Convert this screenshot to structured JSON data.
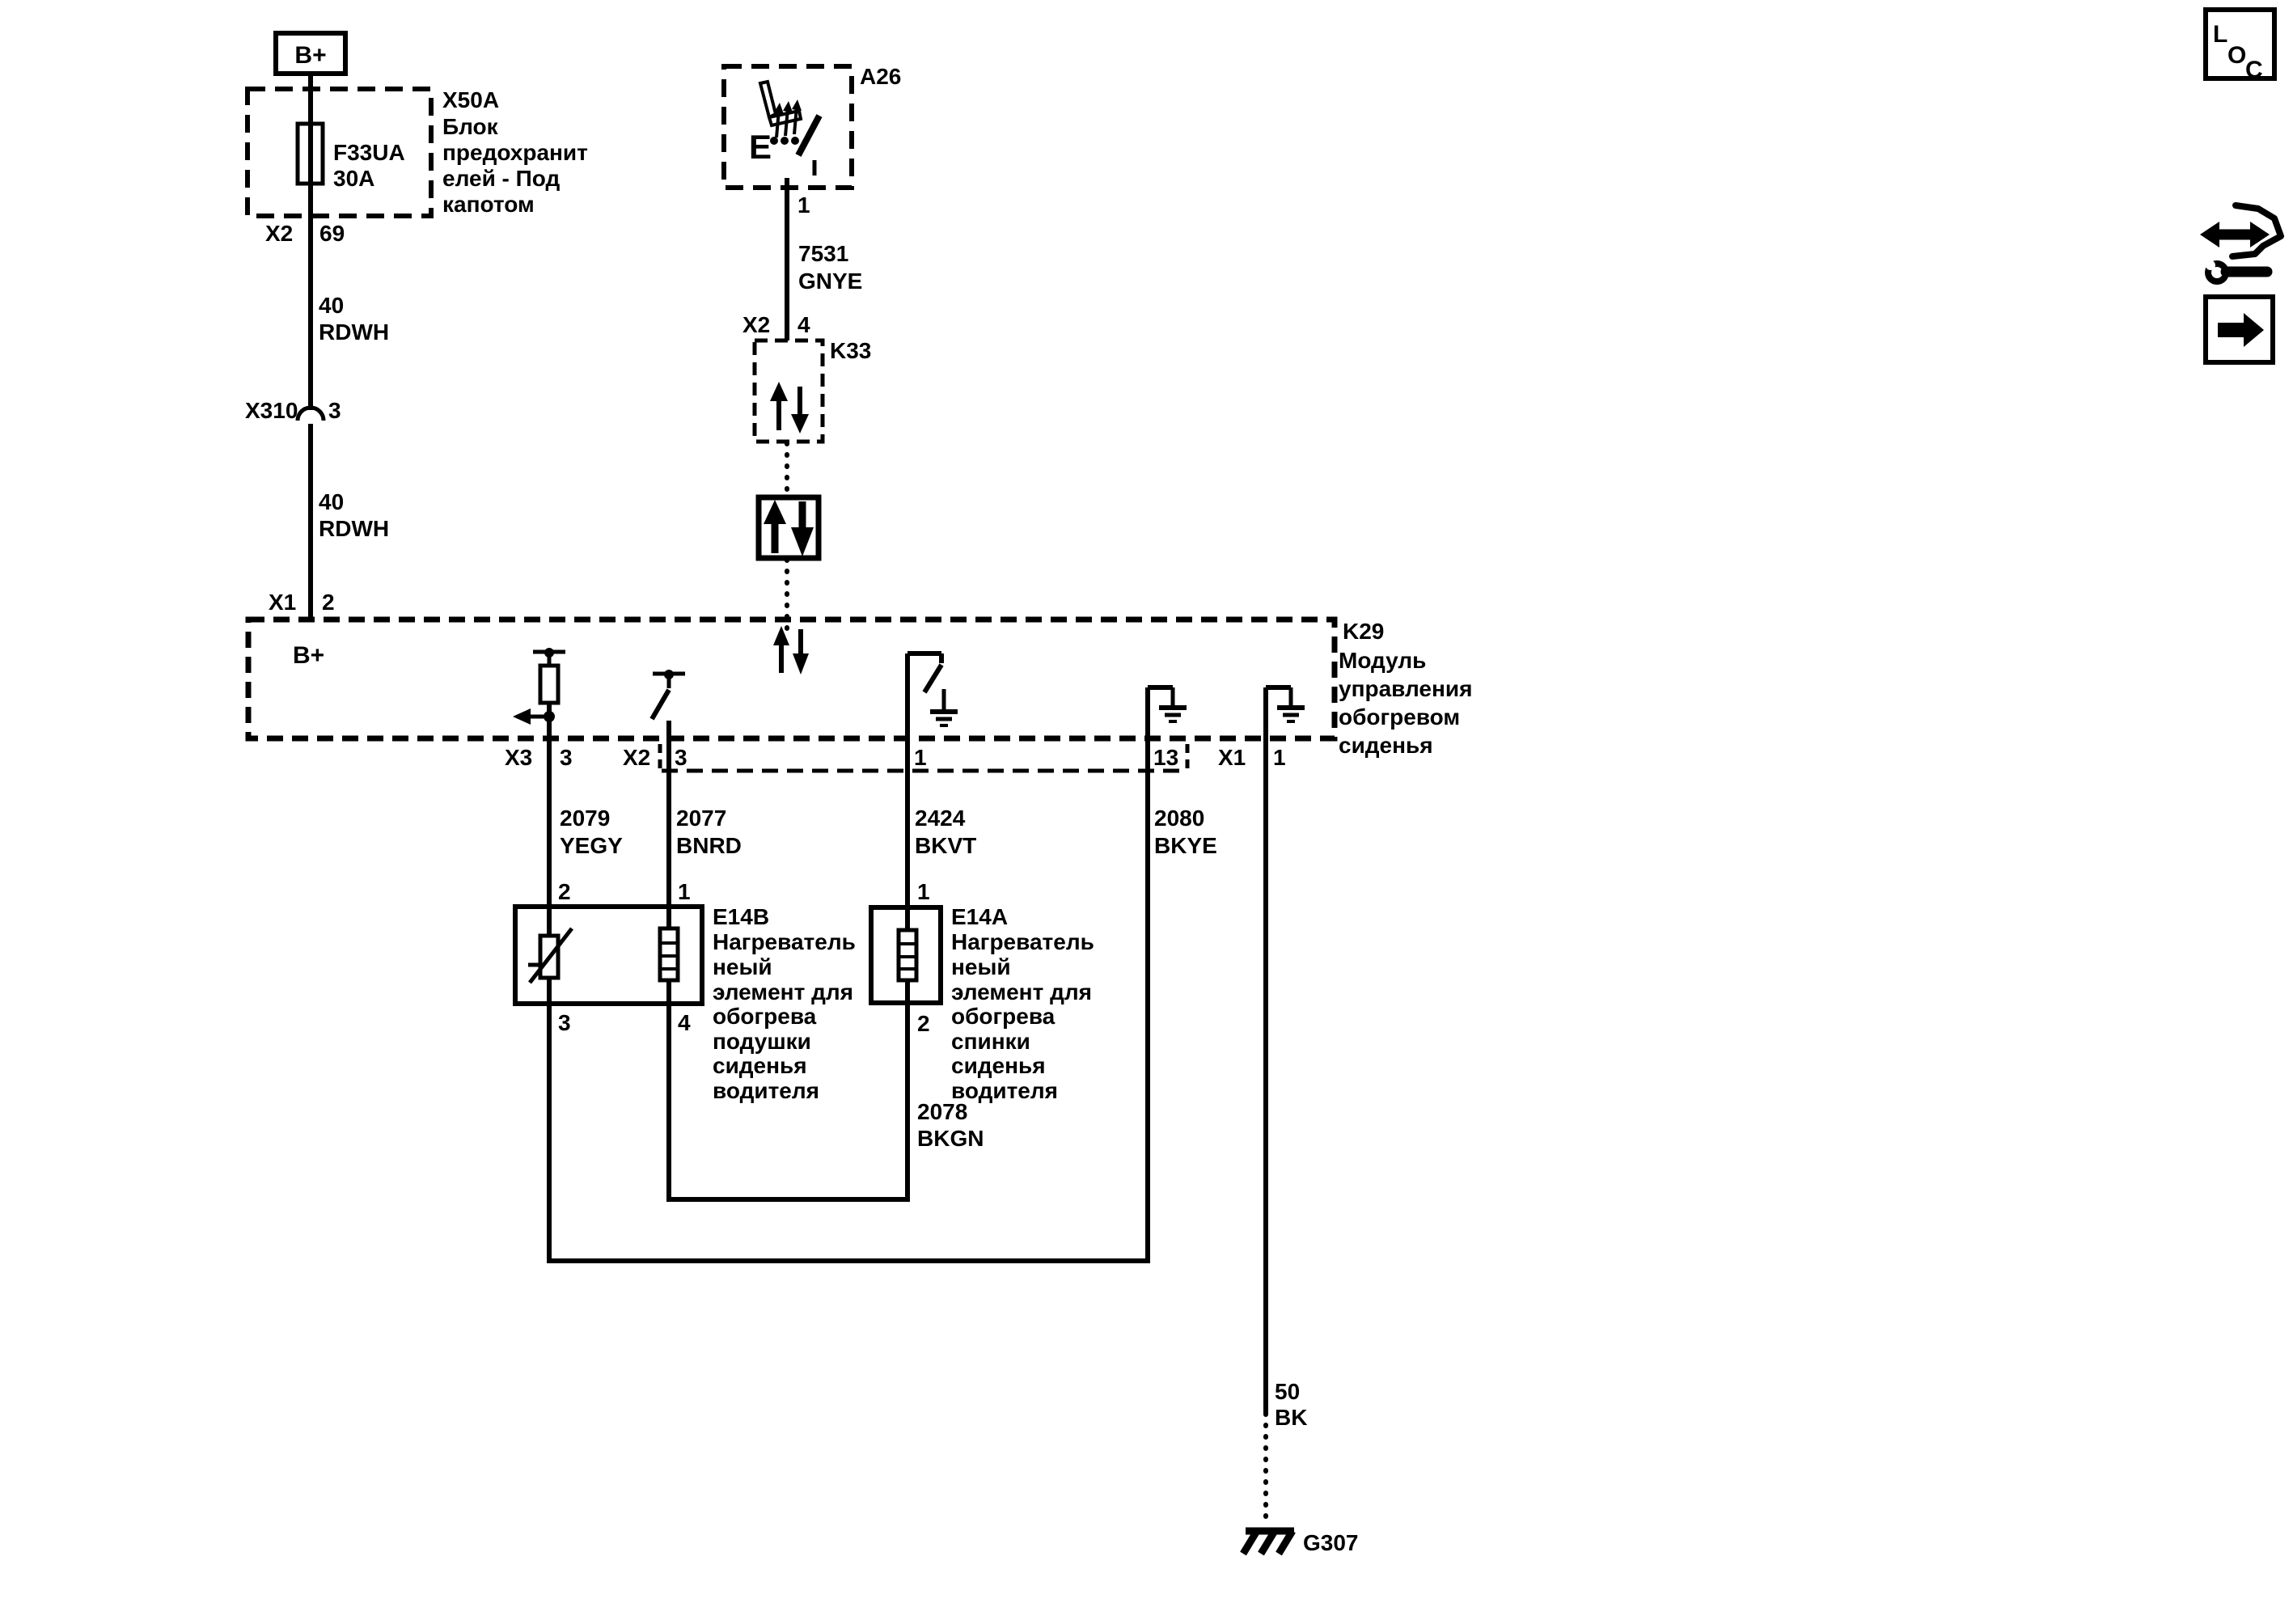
{
  "page": {
    "background": "#ffffff",
    "ink": "#000000"
  },
  "power": {
    "label": "B+"
  },
  "fuse_block": {
    "id": "X50A",
    "name_lines": [
      "Блок",
      "предохранит",
      "елей - Под",
      "капотом"
    ],
    "fuse_id": "F33UA",
    "fuse_rating": "30A",
    "out_connector": "X2",
    "out_pin": "69"
  },
  "wire_40_upper": {
    "circuit": "40",
    "color": "RDWH"
  },
  "inline_connector": {
    "id": "X310",
    "pin": "3"
  },
  "wire_40_lower": {
    "circuit": "40",
    "color": "RDWH"
  },
  "switch_assembly": {
    "id": "A26",
    "contact_letter": "E",
    "pin": "1"
  },
  "wire_7531": {
    "circuit": "7531",
    "color": "GNYE"
  },
  "k33": {
    "id": "K33",
    "connector": "X2",
    "pin": "4"
  },
  "k29": {
    "id": "K29",
    "name_lines": [
      "Модуль",
      "управления",
      "обогревом",
      "сиденья"
    ],
    "internal_b_plus": "B+",
    "in_connector": "X1",
    "in_pin": "2",
    "x3_label": "X3",
    "x3_pin": "3",
    "x2_label": "X2",
    "x2_pin_a": "3",
    "x2_pin_b": "1",
    "x2_pin_c": "13",
    "x1_label": "X1",
    "x1_pin": "1"
  },
  "wire_2079": {
    "circuit": "2079",
    "color": "YEGY"
  },
  "wire_2077": {
    "circuit": "2077",
    "color": "BNRD"
  },
  "wire_2424": {
    "circuit": "2424",
    "color": "BKVT"
  },
  "wire_2080": {
    "circuit": "2080",
    "color": "BKYE"
  },
  "wire_2078": {
    "circuit": "2078",
    "color": "BKGN"
  },
  "wire_50": {
    "circuit": "50",
    "color": "BK"
  },
  "e14b": {
    "id": "E14B",
    "name_lines": [
      "Нагреватель",
      "неый",
      "элемент для",
      "обогрева",
      "подушки",
      "сиденья",
      "водителя"
    ],
    "pin_top_left": "2",
    "pin_top_right": "1",
    "pin_bottom_left": "3",
    "pin_bottom_right": "4"
  },
  "e14a": {
    "id": "E14A",
    "name_lines": [
      "Нагреватель",
      "неый",
      "элемент для",
      "обогрева",
      "спинки",
      "сиденья",
      "водителя"
    ],
    "pin_top": "1",
    "pin_bottom": "2"
  },
  "ground": {
    "id": "G307"
  },
  "corner": {
    "loc": [
      "L",
      "O",
      "C"
    ]
  }
}
